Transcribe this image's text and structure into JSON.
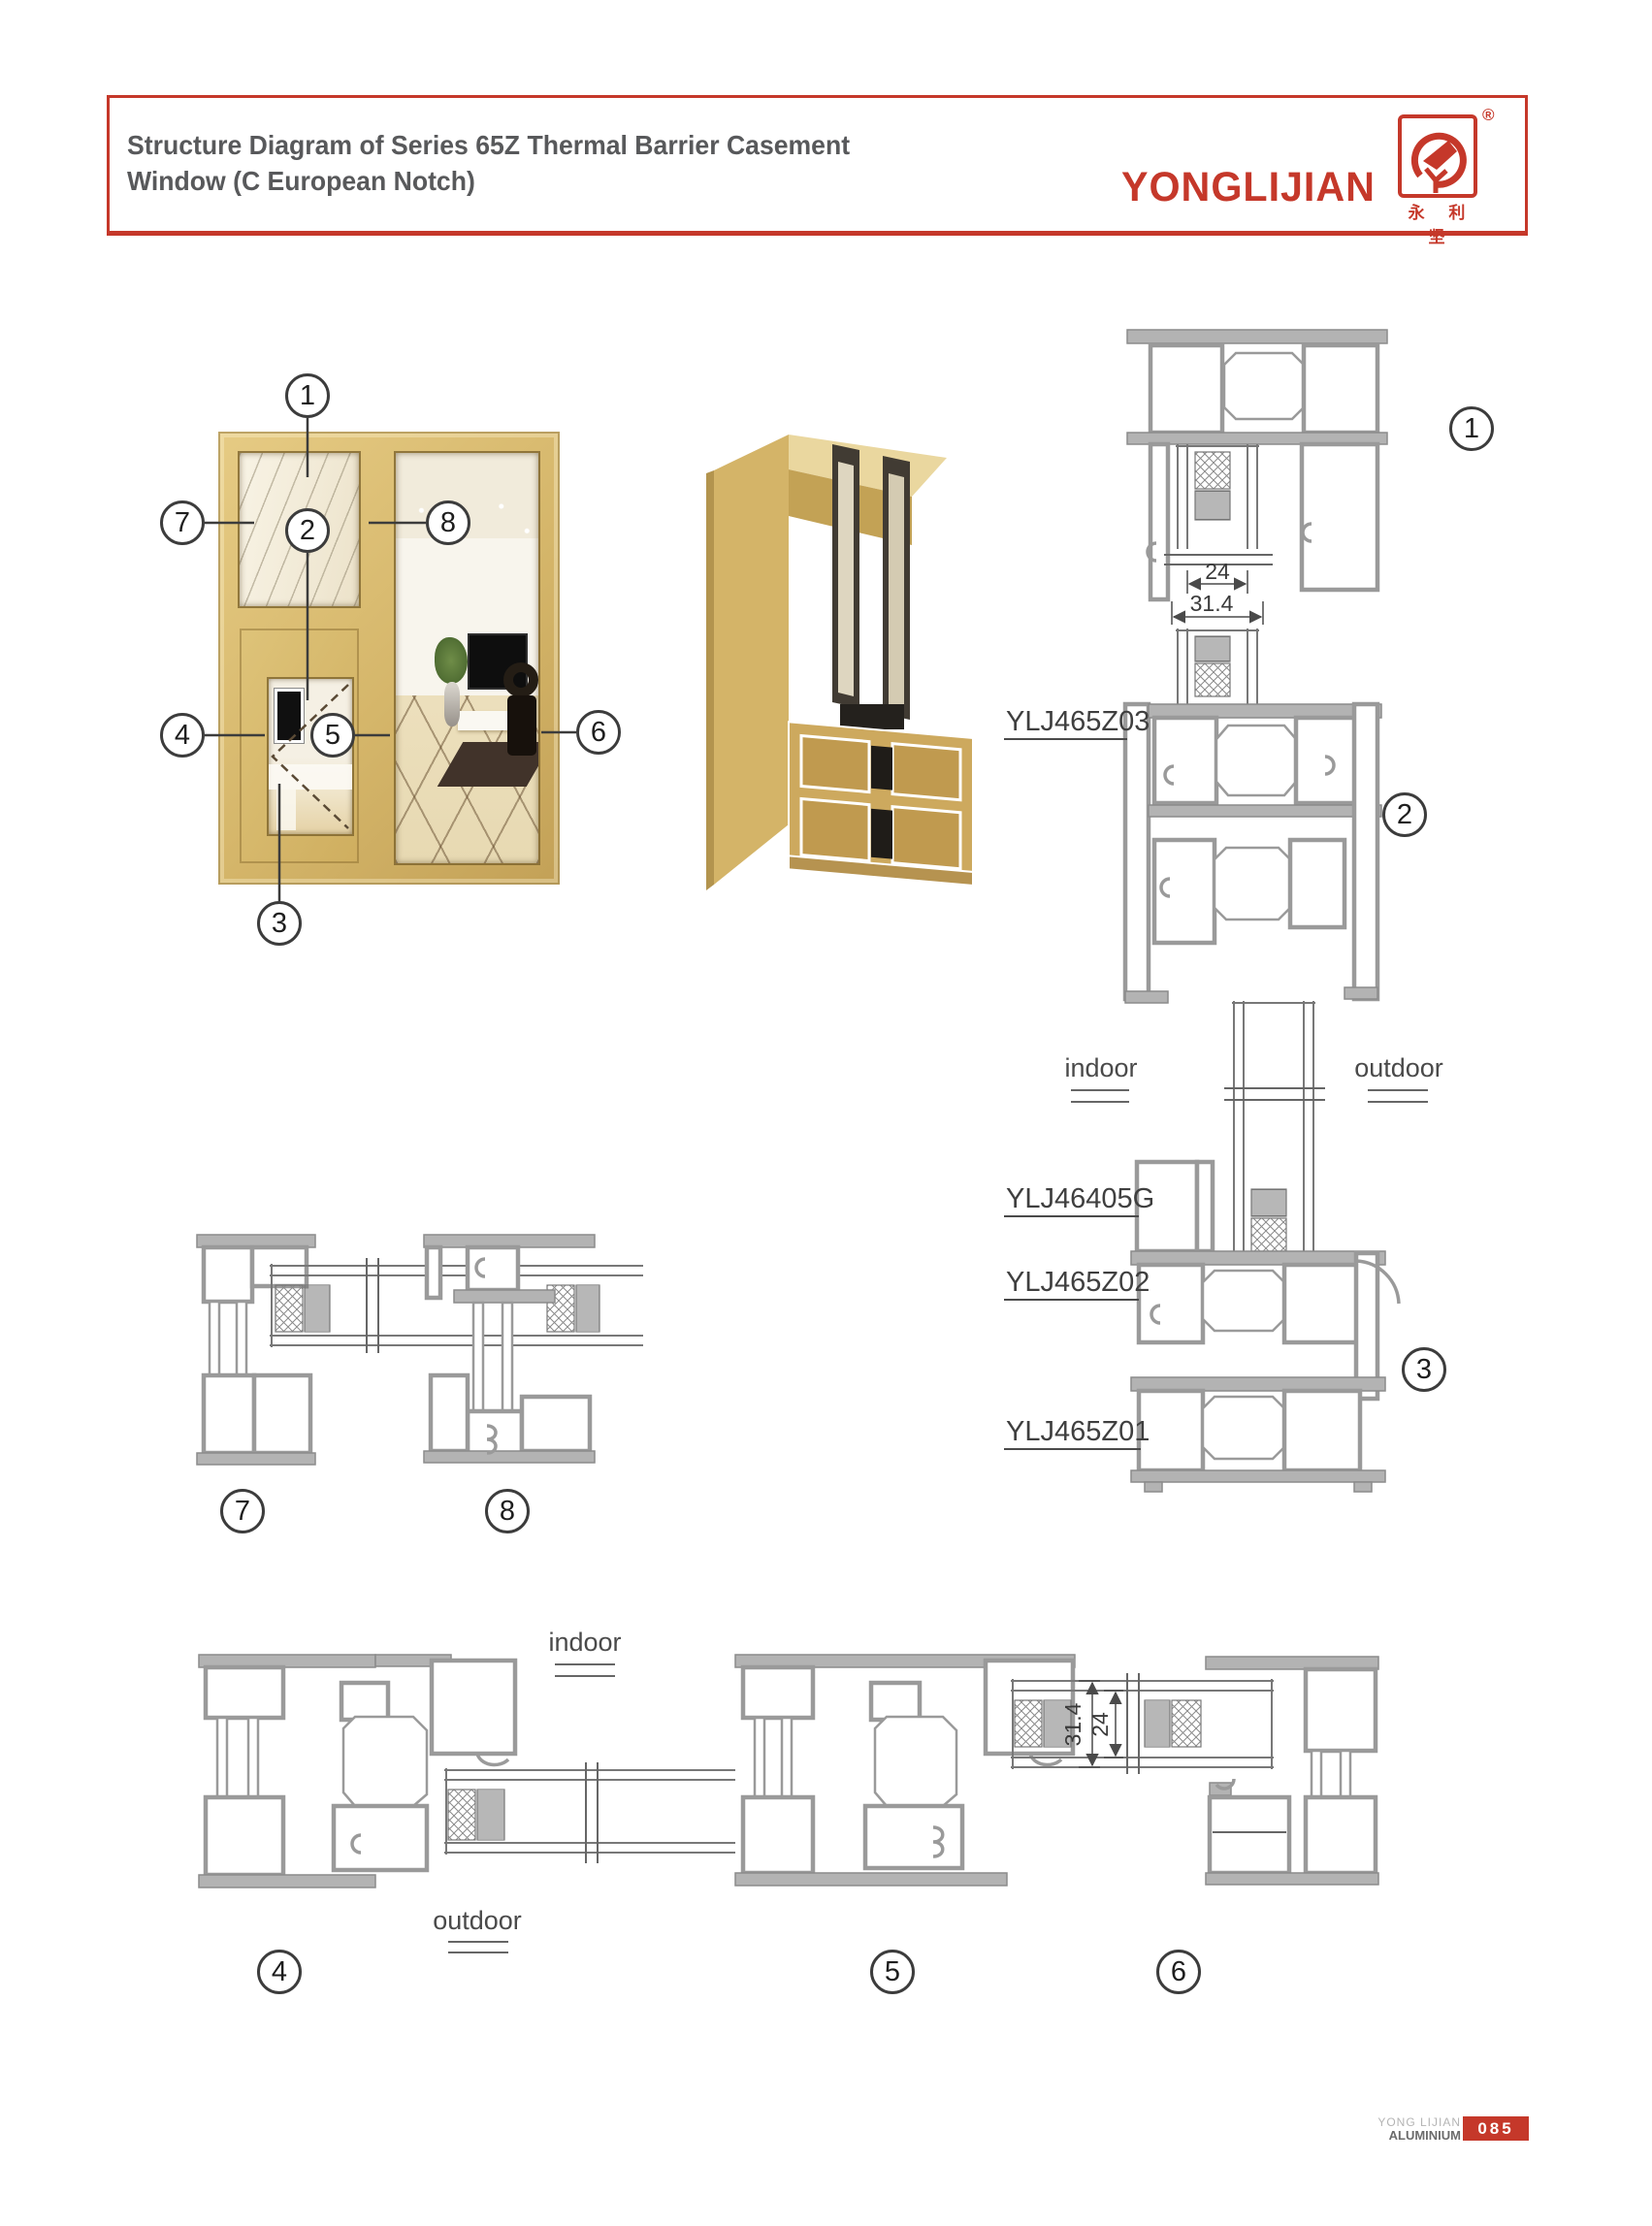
{
  "header": {
    "title_line1": "Structure Diagram of Series 65Z Thermal Barrier Casement",
    "title_line2": "Window (C European Notch)",
    "brand": {
      "name": "YONGLIJIAN",
      "registered": "®",
      "chinese": "永 利 坚"
    }
  },
  "photo_callouts": {
    "n1": "1",
    "n2": "2",
    "n3": "3",
    "n4": "4",
    "n5": "5",
    "n6": "6",
    "n7": "7",
    "n8": "8"
  },
  "right_column": {
    "section_circles": {
      "s1": "1",
      "s2": "2",
      "s3": "3"
    },
    "labels": {
      "l1": "YLJ465Z03",
      "l2": "YLJ46405G",
      "l3": "YLJ465Z02",
      "l4": "YLJ465Z01"
    },
    "indoor": "indoor",
    "outdoor": "outdoor",
    "dim_glass": "24",
    "dim_unit": "31.4"
  },
  "mid_row": {
    "section_circles": {
      "s7": "7",
      "s8": "8"
    }
  },
  "bottom_row": {
    "section_circles": {
      "s4": "4",
      "s5": "5",
      "s6": "6"
    },
    "indoor": "indoor",
    "outdoor": "outdoor",
    "dim_unit": "31.4",
    "dim_glass": "24"
  },
  "footer": {
    "brand_top": "YONG LIJIAN",
    "brand_bottom": "ALUMINIUM",
    "page_number": "085"
  },
  "colors": {
    "accent_red": "#c5382a",
    "title_gray": "#58595b",
    "drawing_gray": "#9a9a9a",
    "frame_gold": "#d7ba72"
  }
}
